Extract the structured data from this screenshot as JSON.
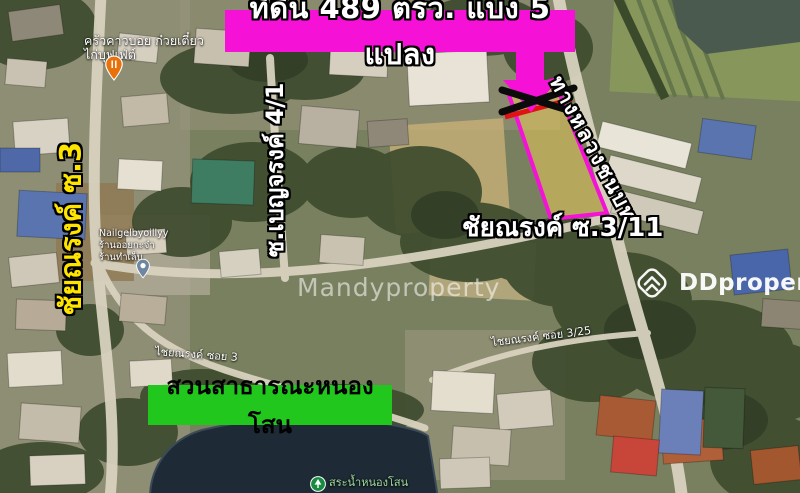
{
  "title_banner": {
    "text": "ที่ดิน 489 ตรว. แบ่ง 5 แปลง"
  },
  "park_banner": {
    "text": "สวนสาธารณะหนองโสน"
  },
  "road_labels": {
    "left_vertical": "ชัยณรงค์ ซ.3",
    "mid_vertical": "ซ.เบญจรงค์ 4/1",
    "highway_diagonal": "ทางหลวงชนบท",
    "soi_3_11": "ชัยณรงค์ ซ.3/11",
    "soi_3_small": "ไชยณรงค์ ซอย 3",
    "soi_3_25_small": "ไชยณรงค์ ซอย 3/25"
  },
  "places": {
    "restaurant": {
      "lines": [
        "ครัวคาวบอย ก๋วยเตี๋ยว",
        "ไก่บุฟเฟ่ต์"
      ],
      "icon": "restaurant-pin"
    },
    "nail_salon": {
      "lines": [
        "Nailgelbyoillyy",
        "ร้านออยกะจ๋า",
        "ร้านทำเล็บ"
      ],
      "icon": "place-pin"
    },
    "pond": {
      "text": "สระน้ำหนองโสน",
      "icon": "park-pin"
    }
  },
  "watermarks": {
    "center": "Mandyproperty",
    "right": "DDproperty"
  },
  "colors": {
    "magenta": "#F511D6",
    "green_banner": "#22C71E",
    "yellow_label": "#FFE400",
    "red_marker": "#E01212",
    "black_marker": "#0B0B0B",
    "plot_fill": "#E8C95A"
  }
}
